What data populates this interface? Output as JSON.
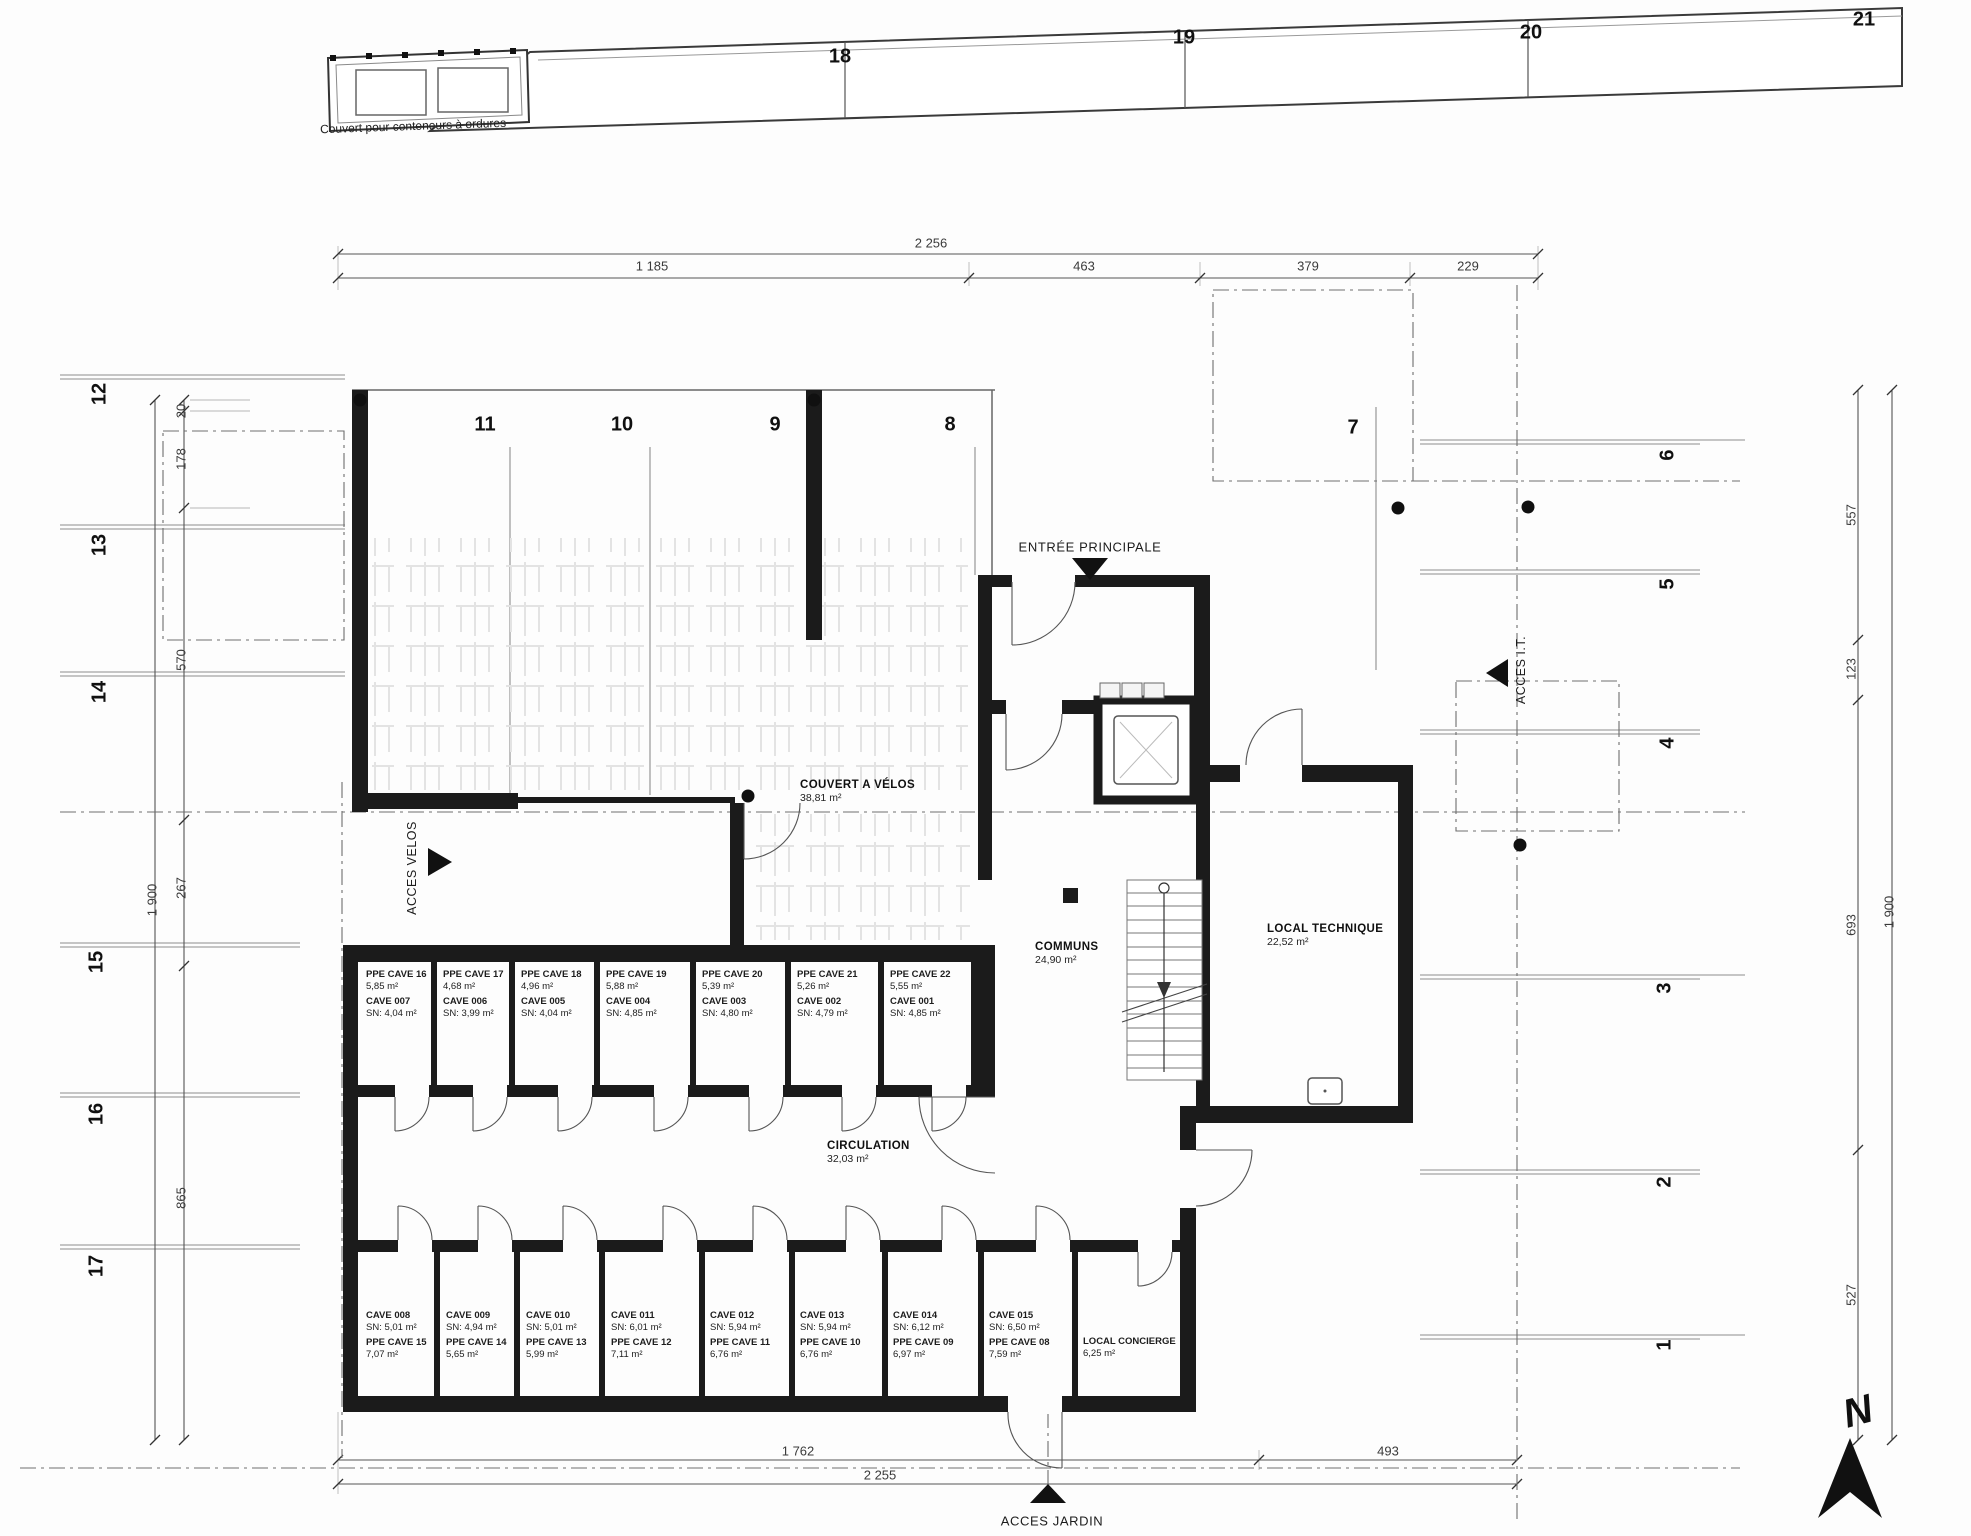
{
  "grid": {
    "top": [
      "18",
      "19",
      "20",
      "21"
    ],
    "middle": [
      "11",
      "10",
      "9",
      "8",
      "7"
    ],
    "left": [
      "12",
      "13",
      "14",
      "15",
      "16",
      "17"
    ],
    "right": [
      "6",
      "5",
      "4",
      "3",
      "2",
      "1"
    ]
  },
  "dimensions": {
    "top_total": "2 256",
    "top_segments": [
      "1 185",
      "463",
      "379",
      "229"
    ],
    "left_segments": [
      "20",
      "178",
      "570",
      "267",
      "865"
    ],
    "left_total": "1 900",
    "right_segments": [
      "557",
      "123",
      "693",
      "527"
    ],
    "right_total": "1 900",
    "bottom_segments": [
      "1 762",
      "493"
    ],
    "bottom_total": "2 255"
  },
  "annotations": {
    "waste_shelter": "Couvert pour conteneurs à ordures",
    "main_entrance": "ENTRÉE PRINCIPALE",
    "bike_access": "ACCES VELOS",
    "it_access": "ACCES I.T.",
    "garden_access": "ACCES JARDIN",
    "north": "N"
  },
  "rooms": {
    "bike_shelter": {
      "name": "COUVERT A VÉLOS",
      "area": "38,81 m²"
    },
    "commons": {
      "name": "COMMUNS",
      "area": "24,90 m²"
    },
    "technical": {
      "name": "LOCAL TECHNIQUE",
      "area": "22,52 m²"
    },
    "circulation": {
      "name": "CIRCULATION",
      "area": "32,03 m²"
    },
    "concierge": {
      "name": "LOCAL CONCIERGE",
      "area": "6,25 m²"
    }
  },
  "caves_top": [
    {
      "ppe": "PPE CAVE 16",
      "ppe_area": "5,85 m²",
      "cave": "CAVE 007",
      "sn": "SN: 4,04 m²"
    },
    {
      "ppe": "PPE CAVE 17",
      "ppe_area": "4,68 m²",
      "cave": "CAVE 006",
      "sn": "SN: 3,99 m²"
    },
    {
      "ppe": "PPE CAVE 18",
      "ppe_area": "4,96 m²",
      "cave": "CAVE 005",
      "sn": "SN: 4,04 m²"
    },
    {
      "ppe": "PPE CAVE 19",
      "ppe_area": "5,88 m²",
      "cave": "CAVE 004",
      "sn": "SN: 4,85 m²"
    },
    {
      "ppe": "PPE CAVE 20",
      "ppe_area": "5,39 m²",
      "cave": "CAVE 003",
      "sn": "SN: 4,80 m²"
    },
    {
      "ppe": "PPE CAVE 21",
      "ppe_area": "5,26 m²",
      "cave": "CAVE 002",
      "sn": "SN: 4,79 m²"
    },
    {
      "ppe": "PPE CAVE 22",
      "ppe_area": "5,55 m²",
      "cave": "CAVE 001",
      "sn": "SN: 4,85 m²"
    }
  ],
  "caves_bottom": [
    {
      "cave": "CAVE 008",
      "sn": "SN: 5,01 m²",
      "ppe": "PPE CAVE 15",
      "ppe_area": "7,07 m²"
    },
    {
      "cave": "CAVE 009",
      "sn": "SN: 4,94 m²",
      "ppe": "PPE CAVE 14",
      "ppe_area": "5,65 m²"
    },
    {
      "cave": "CAVE 010",
      "sn": "SN: 5,01 m²",
      "ppe": "PPE CAVE 13",
      "ppe_area": "5,99 m²"
    },
    {
      "cave": "CAVE 011",
      "sn": "SN: 6,01 m²",
      "ppe": "PPE CAVE 12",
      "ppe_area": "7,11 m²"
    },
    {
      "cave": "CAVE 012",
      "sn": "SN: 5,94 m²",
      "ppe": "PPE CAVE 11",
      "ppe_area": "6,76 m²"
    },
    {
      "cave": "CAVE 013",
      "sn": "SN: 5,94 m²",
      "ppe": "PPE CAVE 10",
      "ppe_area": "6,76 m²"
    },
    {
      "cave": "CAVE 014",
      "sn": "SN: 6,12 m²",
      "ppe": "PPE CAVE 09",
      "ppe_area": "6,97 m²"
    },
    {
      "cave": "CAVE 015",
      "sn": "SN: 6,50 m²",
      "ppe": "PPE CAVE 08",
      "ppe_area": "7,59 m²"
    }
  ]
}
